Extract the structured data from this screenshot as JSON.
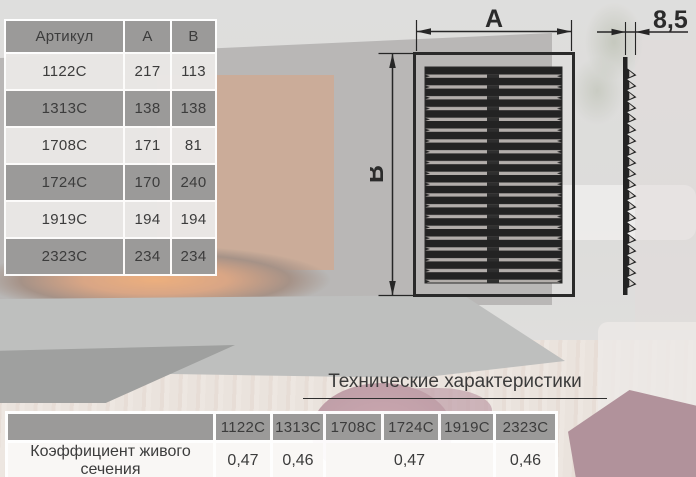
{
  "spec_table": {
    "col_headers": [
      "Артикул",
      "А",
      "В"
    ],
    "rows": [
      {
        "article": "1122С",
        "a": "217",
        "b": "113"
      },
      {
        "article": "1313С",
        "a": "138",
        "b": "138"
      },
      {
        "article": "1708С",
        "a": "171",
        "b": "81"
      },
      {
        "article": "1724С",
        "a": "170",
        "b": "240"
      },
      {
        "article": "1919С",
        "a": "194",
        "b": "194"
      },
      {
        "article": "2323С",
        "a": "234",
        "b": "234"
      }
    ]
  },
  "drawing": {
    "width_dim_label": "А",
    "height_dim_label": "В",
    "depth_dim_label": "8,5"
  },
  "tech": {
    "section_title": "Технические характеристики",
    "row_label": "Коэффициент живого сечения",
    "col_headers": [
      "1122С",
      "1313С",
      "1708С",
      "1724С",
      "1919С",
      "2323С"
    ],
    "values": [
      "0,47",
      "0,46",
      "0,47",
      "0,46"
    ],
    "value_col_spans": [
      1,
      1,
      3,
      1
    ]
  },
  "colors": {
    "cell_gray": "#9b9a99",
    "row_light": "#d9d6d3",
    "text_dark": "#3c3c3c",
    "line_dark": "#262626",
    "border_white": "#ffffff"
  }
}
